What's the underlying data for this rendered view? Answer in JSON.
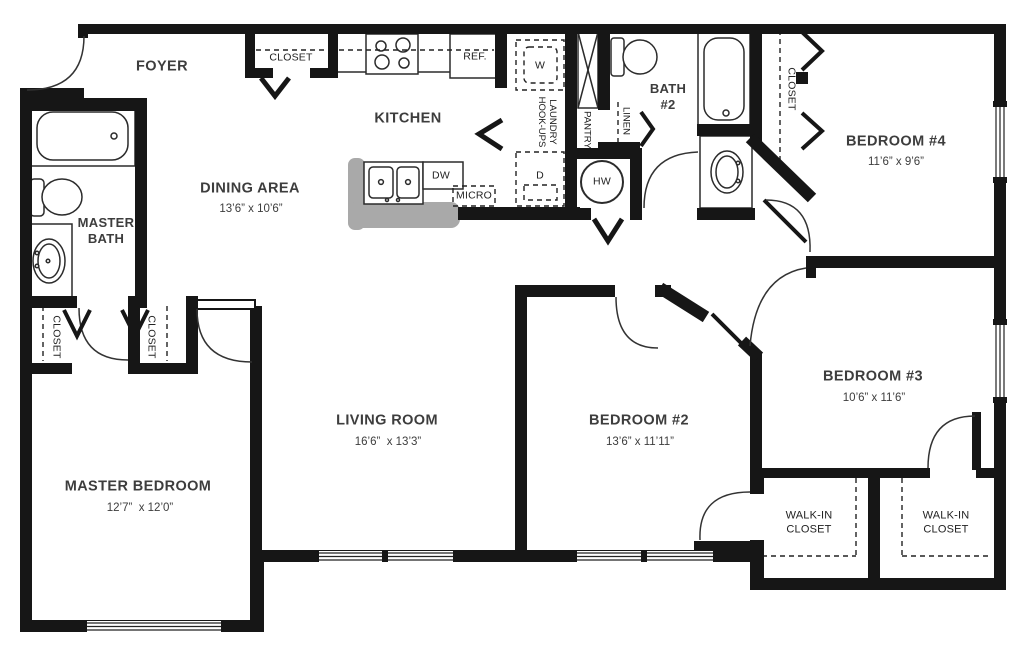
{
  "plan": {
    "title": "4-bedroom apartment floor plan",
    "colors": {
      "walls": "#161616",
      "counter": "#a9a9a9",
      "text": "#3a3a3a"
    },
    "rooms": {
      "foyer": {
        "name": "FOYER"
      },
      "dining": {
        "name": "DINING AREA",
        "dims": "13’6” x 10’6”"
      },
      "kitchen": {
        "name": "KITCHEN"
      },
      "living": {
        "name": "LIVING ROOM",
        "dims": "16’6”  x 13’3”"
      },
      "master_bedroom": {
        "name": "MASTER BEDROOM",
        "dims": "12’7”  x 12’0”"
      },
      "master_bath": {
        "line1": "MASTER",
        "line2": "BATH"
      },
      "bath2": {
        "line1": "BATH",
        "line2": "#2"
      },
      "bedroom2": {
        "name": "BEDROOM #2",
        "dims": "13’6” x 11’11”"
      },
      "bedroom3": {
        "name": "BEDROOM #3",
        "dims": "10’6” x 11’6”"
      },
      "bedroom4": {
        "name": "BEDROOM #4",
        "dims": "11’6” x 9’6”"
      },
      "walkin1": {
        "line1": "WALK-IN",
        "line2": "CLOSET"
      },
      "walkin2": {
        "line1": "WALK-IN",
        "line2": "CLOSET"
      }
    },
    "labels": {
      "closet_foyer": "CLOSET",
      "closet_bed4": "CLOSET",
      "closet_master_left": "CLOSET",
      "closet_master_right": "CLOSET",
      "ref": "REF.",
      "washer": "W",
      "dryer": "D",
      "dishwasher": "DW",
      "micro": "MICRO",
      "water_heater": "HW",
      "pantry": "PANTRY",
      "linen": "LINEN",
      "laundry": {
        "line1": "LAUNDRY",
        "line2": "HOOK-UPS"
      }
    }
  }
}
